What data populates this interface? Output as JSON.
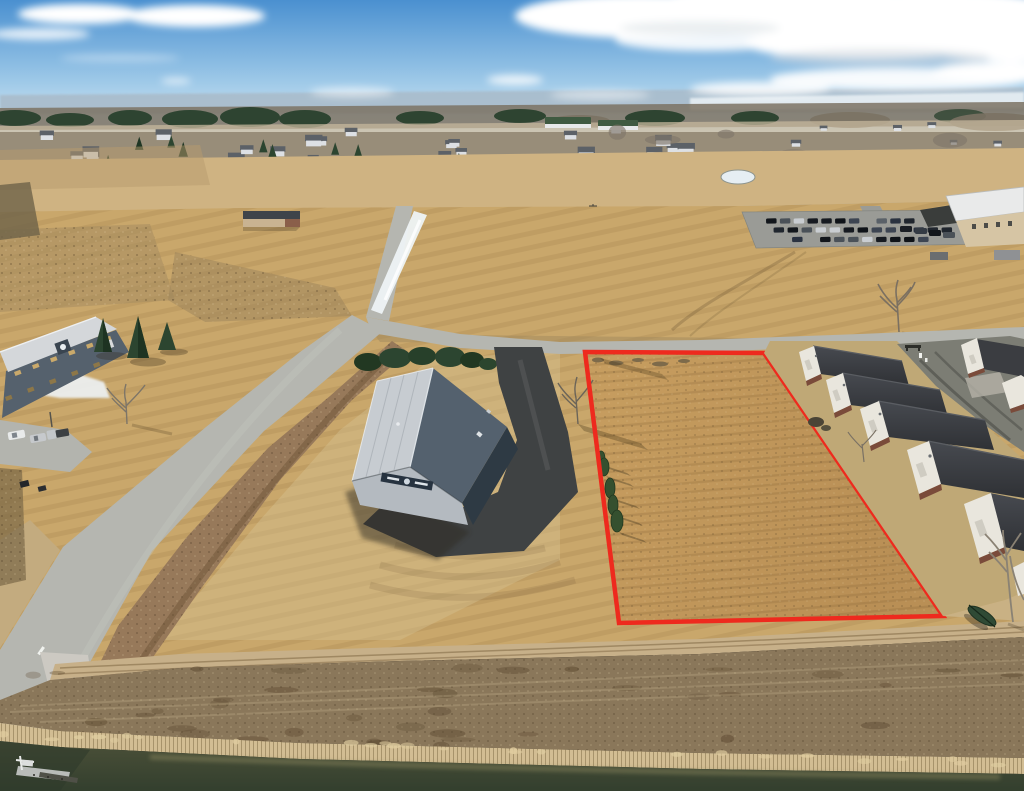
{
  "meta": {
    "type": "aerial-drone-photograph",
    "subject": "Aerial drone photo of a vacant commercial lot outlined in red, winter fields, warehouse and storage units",
    "setting": "small-town commercial park, late winter, midday"
  },
  "palette": {
    "sky_top": "#4a90d0",
    "sky_mid": "#9ec9e8",
    "sky_horizon": "#dcebf4",
    "cloud_white": "#ffffff",
    "cloud_shadow": "#cdd6dc",
    "hills": "#a9bccb",
    "lake": "#e6eef3",
    "treeline_green": "#2e4431",
    "treeline_gray": "#7b7263",
    "suburb_base": "#c6b79c",
    "suburb_wall": "#dde0e4",
    "suburb_roof": "#5c6167",
    "apartment_roof": "#3f5a41",
    "field_light": "#cfb382",
    "field_mid": "#c9a76b",
    "field_warm": "#d6c293",
    "parcel_fill_a": "#c79e60",
    "parcel_fill_b": "#b98f55",
    "parcel_line": "#ee2a1e",
    "road_gray": "#b5b6b0",
    "driveway": "#3f4243",
    "lane_asphalt": "#7c7d74",
    "lot_gray": "#9a9b96",
    "units_roof": "#3b3d41",
    "units_gable": "#e9e6dd",
    "units_base": "#7a4b3a",
    "warehouse_light": "#c7ccd1",
    "warehouse_dark": "#54616e",
    "warehouse_wall": "#2e3a44",
    "warehouse_gable": "#b4bac0",
    "left_roof": "#d4d7da",
    "left_wall": "#55616d",
    "window_amber": "#c9a96b",
    "snow": "#eef3f6",
    "evergreen": "#2c4530",
    "bare_tree": "#80776a",
    "ditch_brown": "#97795a",
    "scrub": "#8a775a",
    "scrub_dark": "#5f4c33",
    "reed": "#d2bd93",
    "track_dirt": "#c7b089",
    "water": "#4b5038",
    "water_dark": "#333f2e",
    "shallow": "#8f8a61",
    "dock": "#b9bcb9",
    "boat_green": "#2f4a35",
    "shadow": "#2f2a22",
    "tan_building_wall": "#c9b391",
    "tan_building_roof": "#3f444a",
    "tr_roof": "#e9eaea",
    "tr_wall": "#d6c5a4"
  },
  "scene": {
    "sky_label": "blue sky with scattered white clouds",
    "horizon_label": "distant wooded ridge and frozen lake",
    "suburb_label": "distant suburban houses among conifers",
    "parcel_label": "vacant parcel highlighted with red boundary",
    "warehouse_label": "gray gabled warehouse with asphalt drive",
    "units_label": "rows of storage condo units",
    "water_label": "pond edge with reeds and dock",
    "counts": {
      "distant_houses": 26,
      "far_right_houses": 6,
      "distant_conifers": 18,
      "bare_tree_blobs": 10,
      "parking_rows": 3,
      "storage_units_near": 5,
      "storage_units_far": 2,
      "cedar_trees": 5,
      "left_lot_vehicles": 3,
      "scrub_mottles": 40,
      "reed_tufts": 26
    },
    "car_colors": [
      "#12161b",
      "#2a3240",
      "#3d4552",
      "#161a20",
      "#4a5158",
      "#20262e",
      "#5a6168",
      "#0f1318",
      "#c9cdd1"
    ],
    "parking_rows_spec": [
      {
        "y": 218.5,
        "x0": 766,
        "n": 13,
        "step": 13.8
      },
      {
        "y": 227.5,
        "x0": 772,
        "n": 13,
        "step": 14.0
      },
      {
        "y": 237.0,
        "x0": 789,
        "n": 11,
        "step": 14.0
      }
    ],
    "cedar_row": [
      [
        601,
        458,
        4,
        7
      ],
      [
        604,
        467,
        5,
        9
      ],
      [
        610,
        488,
        5,
        10
      ],
      [
        613,
        505,
        5,
        10
      ],
      [
        617,
        521,
        6,
        11
      ]
    ]
  }
}
